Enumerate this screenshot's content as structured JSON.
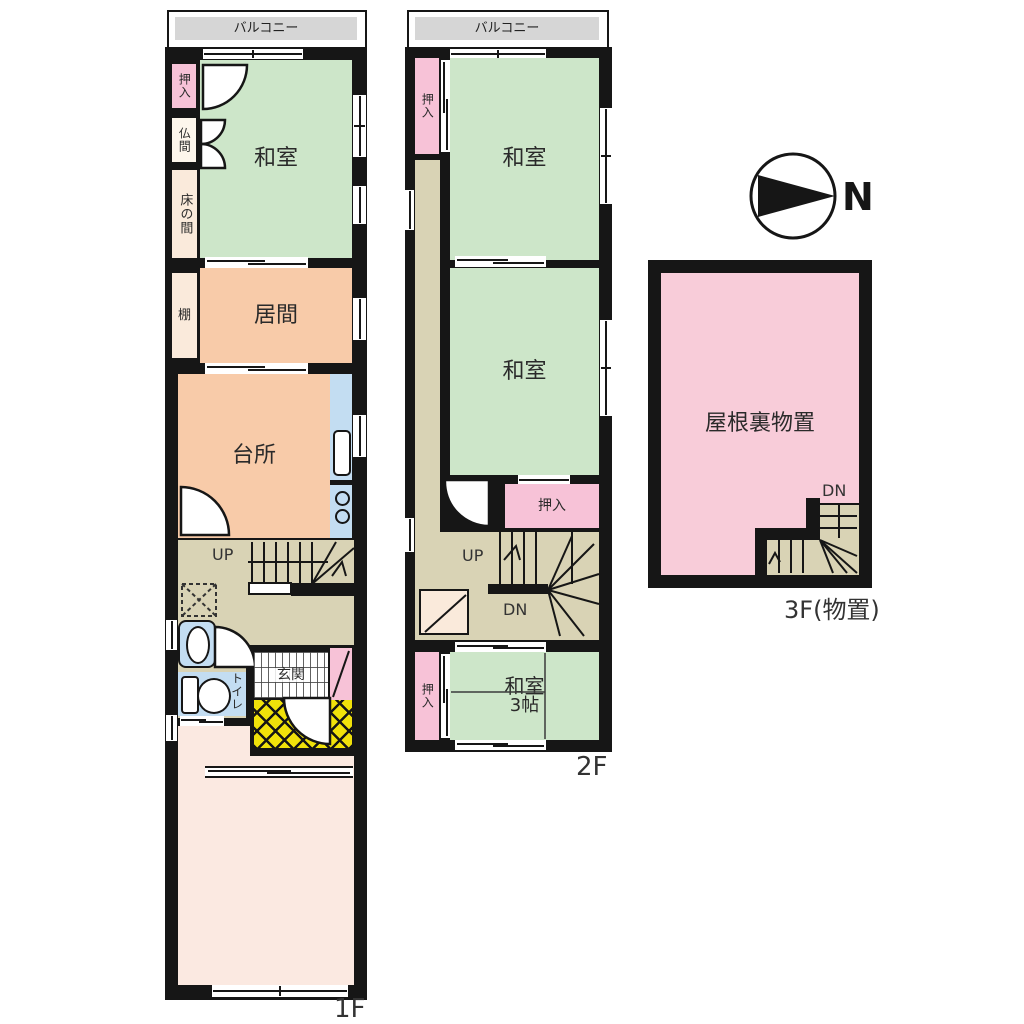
{
  "palette": {
    "wall": "#161616",
    "balcony_gray": "#d6d6d6",
    "tatami_green": "#cde6c9",
    "wood_peach": "#f8cba9",
    "closet_pink": "#f7c2d7",
    "cream": "#faeadb",
    "cream_light": "#fdf6ec",
    "hall_khaki": "#d9d3b5",
    "water_blue": "#c3ddf2",
    "porch_yellow": "#f0e10a",
    "room_blush": "#fbe9e1",
    "attic_pink": "#f8ccd9",
    "label_dark": "#2a2a2a"
  },
  "floor1": {
    "floor_label": "1F",
    "balcony": "バルコニー",
    "closet": "押入",
    "butsuma": "仏間",
    "tokonoma": "床の間",
    "washitsu": "和室",
    "shelf": "棚",
    "living": "居間",
    "kitchen": "台所",
    "stairs_up": "UP",
    "toilet": "トイレ",
    "entrance": "玄関"
  },
  "floor2": {
    "floor_label": "2F",
    "balcony": "バルコニー",
    "closet_top": "押入",
    "washitsu_1": "和室",
    "washitsu_2": "和室",
    "closet_mid": "押入",
    "stairs_up": "UP",
    "stairs_dn": "DN",
    "closet_bottom": "押入",
    "washitsu_3_name": "和室",
    "washitsu_3_size": "3帖"
  },
  "floor3": {
    "floor_label": "3F(物置)",
    "attic": "屋根裏物置",
    "stairs_dn": "DN"
  },
  "compass": {
    "north": "N"
  }
}
